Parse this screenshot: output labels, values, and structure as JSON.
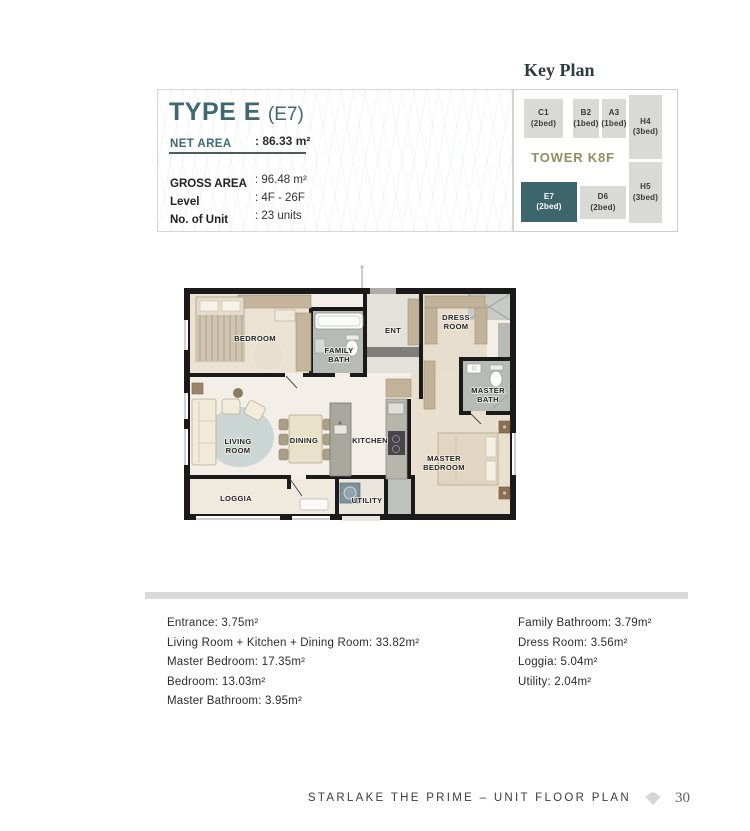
{
  "colors": {
    "accent_teal": "#3d6a70",
    "keyplan_highlight": "#3c666b",
    "keyplan_cell": "#d9d9d6",
    "tower_label": "#8f8f63",
    "divider_bar": "#dadada"
  },
  "unit_info": {
    "type_title": "TYPE E",
    "type_code": "(E7)",
    "net_area_label": "NET AREA",
    "net_area_value": ": 86.33 m²",
    "rows": [
      {
        "label": "GROSS AREA",
        "value": ": 96.48 m²"
      },
      {
        "label": "Level",
        "value": ": 4F - 26F"
      },
      {
        "label": "No. of Unit",
        "value": ": 23 units"
      }
    ]
  },
  "key_plan": {
    "title": "Key Plan",
    "tower_label": "TOWER K8F",
    "cells": [
      {
        "code": "C1",
        "beds": "(2bed)",
        "highlighted": false
      },
      {
        "code": "B2",
        "beds": "(1bed)",
        "highlighted": false
      },
      {
        "code": "A3",
        "beds": "(1bed)",
        "highlighted": false
      },
      {
        "code": "H4",
        "beds": "(3bed)",
        "highlighted": false
      },
      {
        "code": "E7",
        "beds": "(2bed)",
        "highlighted": true
      },
      {
        "code": "D6",
        "beds": "(2bed)",
        "highlighted": false
      },
      {
        "code": "H5",
        "beds": "(3bed)",
        "highlighted": false
      }
    ]
  },
  "floor_plan": {
    "rooms": [
      {
        "name": "bedroom",
        "lines": [
          "BEDROOM"
        ]
      },
      {
        "name": "family-bath",
        "lines": [
          "FAMILY",
          "BATH"
        ]
      },
      {
        "name": "entrance",
        "lines": [
          "ENT"
        ]
      },
      {
        "name": "dress-room",
        "lines": [
          "DRESS",
          "ROOM"
        ]
      },
      {
        "name": "master-bath",
        "lines": [
          "MASTER",
          "BATH"
        ]
      },
      {
        "name": "living-room",
        "lines": [
          "LIVING",
          "ROOM"
        ]
      },
      {
        "name": "dining",
        "lines": [
          "DINING"
        ]
      },
      {
        "name": "kitchen",
        "lines": [
          "KITCHEN"
        ]
      },
      {
        "name": "master-bedroom",
        "lines": [
          "MASTER",
          "BEDROOM"
        ]
      },
      {
        "name": "loggia",
        "lines": [
          "LOGGIA"
        ]
      },
      {
        "name": "utility",
        "lines": [
          "UTILITY"
        ]
      }
    ]
  },
  "area_list": {
    "left": [
      "Entrance: 3.75m²",
      "Living Room + Kitchen + Dining Room: 33.82m²",
      "Master Bedroom: 17.35m²",
      "Bedroom: 13.03m²",
      "Master Bathroom: 3.95m²"
    ],
    "right": [
      "Family Bathroom: 3.79m²",
      "Dress Room: 3.56m²",
      "Loggia: 5.04m²",
      "Utility: 2.04m²"
    ]
  },
  "footer": {
    "title": "STARLAKE THE PRIME – UNIT FLOOR PLAN",
    "page_number": "30"
  }
}
